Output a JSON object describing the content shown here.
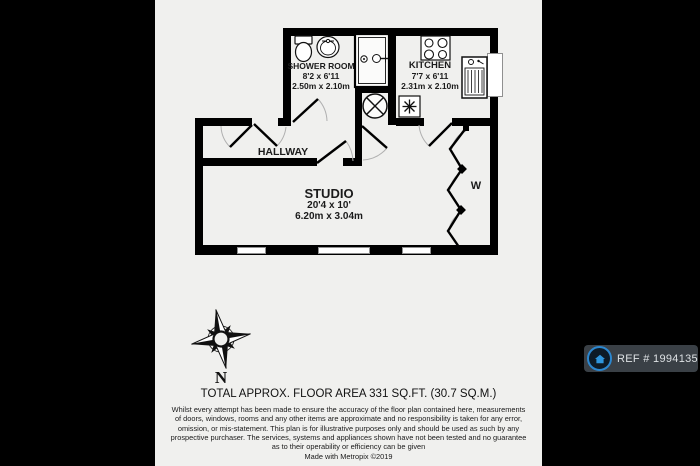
{
  "plan": {
    "rooms": {
      "shower_room": {
        "name": "SHOWER ROOM",
        "dims_imperial": "8'2 x 6'11",
        "dims_metric": "2.50m x 2.10m"
      },
      "kitchen": {
        "name": "KITCHEN",
        "dims_imperial": "7'7 x 6'11",
        "dims_metric": "2.31m x 2.10m"
      },
      "hallway": {
        "name": "HALLWAY"
      },
      "studio": {
        "name": "STUDIO",
        "dims_imperial": "20'4 x 10'",
        "dims_metric": "6.20m x 3.04m"
      },
      "wardrobe": {
        "label": "W"
      }
    },
    "compass": {
      "label": "N"
    },
    "icons": {
      "toilet": "toilet-icon",
      "basin": "basin-icon",
      "shower": "shower-enclosure-icon",
      "extractor_fan": "circle-x",
      "hob": "four-burner-hob",
      "freezer": "snowflake",
      "sink": "sink-drainer",
      "wardrobe_doors": "bifold-zigzag",
      "compass": "eight-point-rose",
      "badge_house": "house-icon"
    }
  },
  "footer": {
    "area_title": "TOTAL APPROX. FLOOR AREA 331 SQ.FT. (30.7 SQ.M.)",
    "disclaimer_lines": [
      "Whilst every attempt has been made to ensure the accuracy of the floor plan contained here, measurements",
      "of doors, windows, rooms and any other items are approximate and no responsibility is taken for any error,",
      "omission, or mis-statement. This plan is for illustrative purposes only and should be used as such by any",
      "prospective purchaser. The services, systems and appliances shown have not been tested and no guarantee",
      "as to their operability or efficiency can be given"
    ],
    "credit": "Made with Metropix ©2019"
  },
  "badge": {
    "ref_label": "REF # 1994135"
  },
  "colors": {
    "background": "#000000",
    "paper": "#f0f0ee",
    "wall": "#000000",
    "badge_bg": "#3a4046",
    "badge_ring": "#2c87cf",
    "badge_house": "#2f96dd",
    "badge_text": "#dde1e4",
    "arc": "#b0b0b0"
  }
}
